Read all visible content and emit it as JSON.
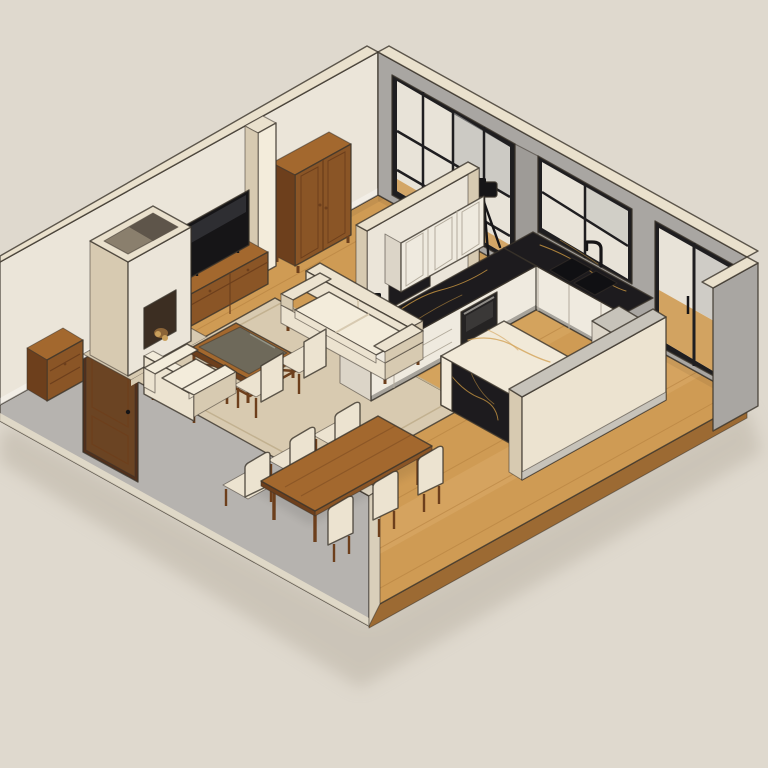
{
  "meta": {
    "type": "isometric-interior-render",
    "view": "isometric-cutaway-floor-plan",
    "visible_text": "none"
  },
  "scene": {
    "description": "Isometric cutaway 3D render of an open-plan apartment: living room with fireplace, TV and cream seating; kitchen with black marble counters, white cabinets and marble island; dining table for six; large black-framed windows and a balcony glass door",
    "living_room": {
      "items": [
        "fireplace",
        "television",
        "tv-media-console",
        "armoire-cabinet",
        "wall-pilaster",
        "side-table",
        "sofa",
        "armchair",
        "coffee-table",
        "accent-chair",
        "accent-chair",
        "area-rug"
      ]
    },
    "kitchen": {
      "items": [
        "partition-wall-with-pass-through",
        "upper-cabinets",
        "counter-window-run",
        "counter-partition-run",
        "double-sink",
        "black-faucet",
        "built-in-oven",
        "kitchen-island",
        "end-column",
        "cutaway-pony-wall"
      ]
    },
    "dining": {
      "items": [
        "dining-table",
        "dining-chair",
        "dining-chair",
        "dining-chair",
        "dining-chair",
        "dining-chair",
        "dining-chair"
      ]
    },
    "architecture": {
      "items": [
        "wood-plank-floor",
        "northwest-wall",
        "northeast-wall",
        "front-wall",
        "entry-door",
        "picture-window",
        "kitchen-window",
        "balcony-glass-door",
        "right-return-wall",
        "light-switch"
      ]
    },
    "props": {
      "items": [
        "camera-on-tripod"
      ]
    }
  },
  "colors": {
    "bg": "#dfd9ce",
    "shadow": "#b9b1a3",
    "wall_int": "#ebe5d9",
    "wall_gray": "#a9a6a2",
    "wall_gray2": "#9e9b97",
    "wall_ext": "#b6b3af",
    "coping": "#eae1cd",
    "coping_shade": "#d9cfba",
    "floor": "#cf9b54",
    "floor_line": "#b07c3b",
    "floor_light": "#e6bd7e",
    "slab_side": "#9c6a33",
    "rug": "#d8cab0",
    "rug_line": "#c2b190",
    "wood": "#8a5526",
    "wood_dark": "#6d3f1c",
    "wood_light": "#a3682e",
    "cream": "#ece3d0",
    "cream_light": "#f3ecdb",
    "cream_shade": "#d7cab1",
    "marble_black": "#1d1b1e",
    "gold": "#c29140",
    "marble_white": "#f1e9d8",
    "marble_vein": "#d3a258",
    "frame": "#1f1e20",
    "glass": "#e8e3d8",
    "glass_gray": "#b5b6b4",
    "cab_white": "#efeadf",
    "cab_shade": "#dcd5c8",
    "cab_line": "#b3ab9c",
    "appliance": "#252323",
    "metal": "#c7c3ba",
    "door": "#6b4423",
    "door_dark": "#52301b",
    "black": "#161517",
    "outline": "#3a332b",
    "fire_dark": "#3c2e22",
    "fire_glow": "#d99a4c",
    "log": "#c9a05c"
  }
}
